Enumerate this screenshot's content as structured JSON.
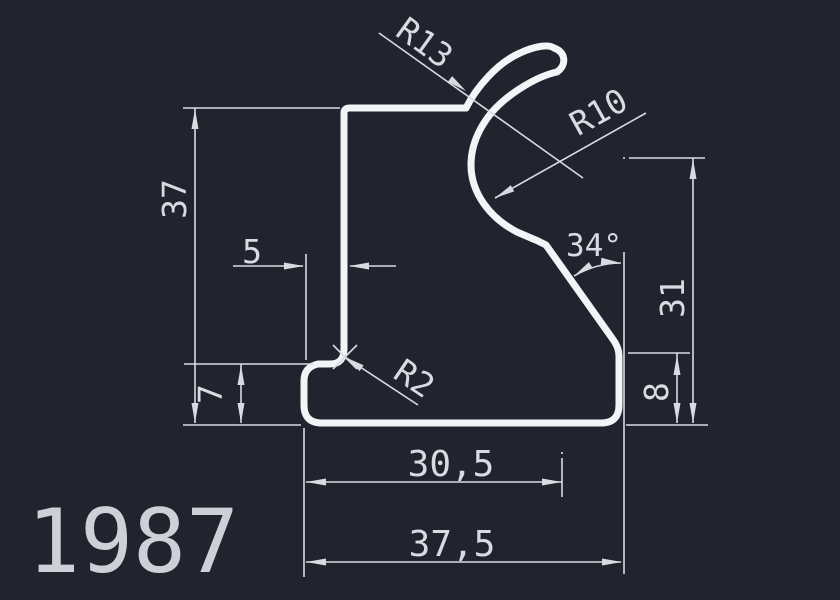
{
  "canvas": {
    "width": 840,
    "height": 600,
    "colors": {
      "bg": "#20242e",
      "line": "#f2f4f7",
      "dim": "#d8dce2",
      "title": "#ccd1d8"
    }
  },
  "drawing": {
    "profile_id": "1987",
    "dimensions": {
      "total_height": "37",
      "step_height": "7",
      "step_offset": "5",
      "hook_outer_radius": "R13",
      "hook_inner_radius": "R10",
      "fillet_radius": "R2",
      "slant_angle": "34°",
      "right_height": "31",
      "foot_height": "8",
      "inner_width": "30,5",
      "total_width": "37,5"
    }
  }
}
